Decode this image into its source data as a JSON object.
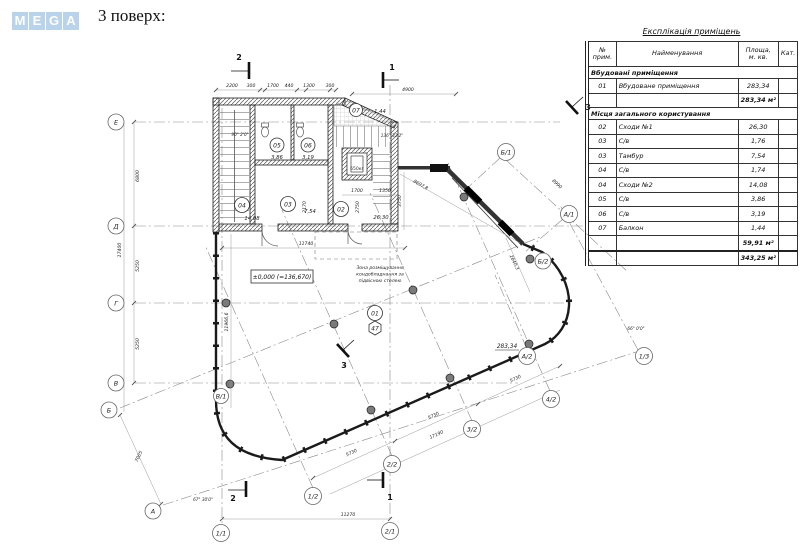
{
  "logo": {
    "letters": [
      "M",
      "E",
      "G",
      "A"
    ],
    "color": "#b9d3ea"
  },
  "header": {
    "title": "3 поверх:"
  },
  "table": {
    "title": "Експлікація приміщень",
    "col_num1": "№",
    "col_num2": "прим.",
    "col_name": "Найменування",
    "col_area1": "Площа,",
    "col_area2": "м. кв.",
    "col_cat": "Кат.",
    "section1": "Вбудовані приміщення",
    "rows1": [
      {
        "num": "01",
        "name": "Вбудоване приміщення",
        "area": "283,34"
      }
    ],
    "subtotal1": "283,34 м²",
    "section2": "Місця загального користування",
    "rows2": [
      {
        "num": "02",
        "name": "Сходи №1",
        "area": "26,30"
      },
      {
        "num": "03",
        "name": "С/в",
        "area": "1,76"
      },
      {
        "num": "03",
        "name": "Тамбур",
        "area": "7,54"
      },
      {
        "num": "04",
        "name": "С/в",
        "area": "1,74"
      },
      {
        "num": "04",
        "name": "Сходи №2",
        "area": "14,08"
      },
      {
        "num": "05",
        "name": "С/в",
        "area": "3,86"
      },
      {
        "num": "06",
        "name": "С/в",
        "area": "3,19"
      },
      {
        "num": "07",
        "name": "Балкон",
        "area": "1,44"
      }
    ],
    "subtotal2": "59,91 м²",
    "total": "343,25 м²"
  },
  "plan": {
    "grid": {
      "E": "Е",
      "D": "Д",
      "G": "Г",
      "V": "В",
      "B": "Б",
      "A": "А",
      "n11": "1/1",
      "n21": "2/1",
      "n12": "1/2",
      "n22": "2/2",
      "n32": "3/2",
      "n42": "4/2",
      "n13": "1/3",
      "a1": "А/1",
      "b1": "Б/1",
      "a2": "А/2",
      "b2": "Б/2",
      "v1": "В/1"
    },
    "sections": {
      "s1": "1",
      "s2": "2",
      "s3": "3"
    },
    "dims": {
      "d2200": "2200",
      "d300": "300",
      "d1700": "1700",
      "d440": "440",
      "d1300": "1300",
      "d4900": "4900",
      "d11740": "11740",
      "d11270": "11270",
      "d17190": "17190",
      "d5730": "5730",
      "d6800": "6800",
      "d5250": "5250",
      "d17400": "17400",
      "d11966": "11966,6",
      "d3750": "3750",
      "d8697": "8697,8",
      "d8990": "8990",
      "d2640": "2640,3",
      "d7005": "7005",
      "d1700i": "1700",
      "d1350": "1350",
      "d2170": "2170",
      "d2750": "2750"
    },
    "angles": {
      "a90": "90° 2'0\"",
      "a136": "136° 32'2\"",
      "a67": "67° 30'0\"",
      "a66": "66° 0'0\""
    },
    "texts": {
      "elev": "±0,000 (=136,670)",
      "area_label": "283,34",
      "note1": "Зона розміщування",
      "note2": "кондобладнання за",
      "note3": "підвісною стелею",
      "lift": "650кг",
      "tag01": "01",
      "tag47": "47"
    },
    "rooms": [
      {
        "num": "02",
        "area": "26,30"
      },
      {
        "num": "03",
        "area": "7,54"
      },
      {
        "num": "04",
        "area": "14,08"
      },
      {
        "num": "05",
        "area": "3,86"
      },
      {
        "num": "06",
        "area": "3,19"
      },
      {
        "num": "07",
        "area": "1,44"
      }
    ]
  }
}
